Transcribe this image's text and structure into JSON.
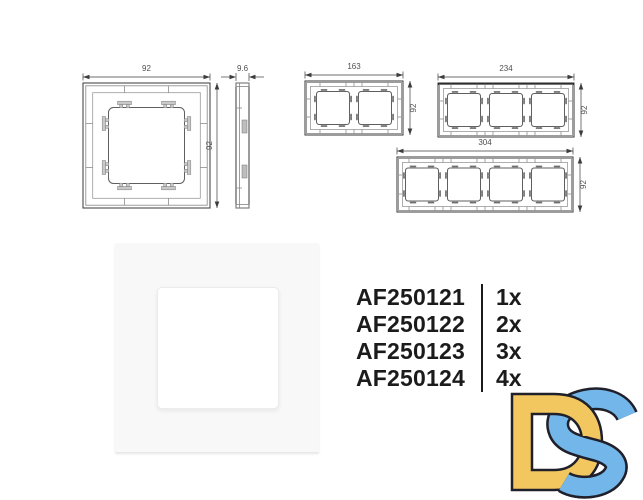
{
  "technical_drawings": {
    "single_frame": {
      "front_width_label": "92",
      "front_height_label": "92",
      "side_width_label": "9.6"
    },
    "two_gang": {
      "width_label": "163",
      "height_label": "92"
    },
    "three_gang": {
      "width_label": "234",
      "height_label": "92"
    },
    "four_gang": {
      "width_label": "304",
      "height_label": "92"
    }
  },
  "product_list": {
    "items": [
      {
        "code": "AF250121",
        "qty": "1x"
      },
      {
        "code": "AF250122",
        "qty": "2x"
      },
      {
        "code": "AF250123",
        "qty": "3x"
      },
      {
        "code": "AF250124",
        "qty": "4x"
      }
    ]
  },
  "logo": {
    "letters": "DS",
    "d_color": "#f2c75f",
    "s_color": "#72b6ea",
    "outline_color": "#20202b"
  },
  "colors": {
    "drawing_line": "#4a4a4a",
    "text": "#1b1b1b",
    "photo_background": "#f8f8f8"
  }
}
